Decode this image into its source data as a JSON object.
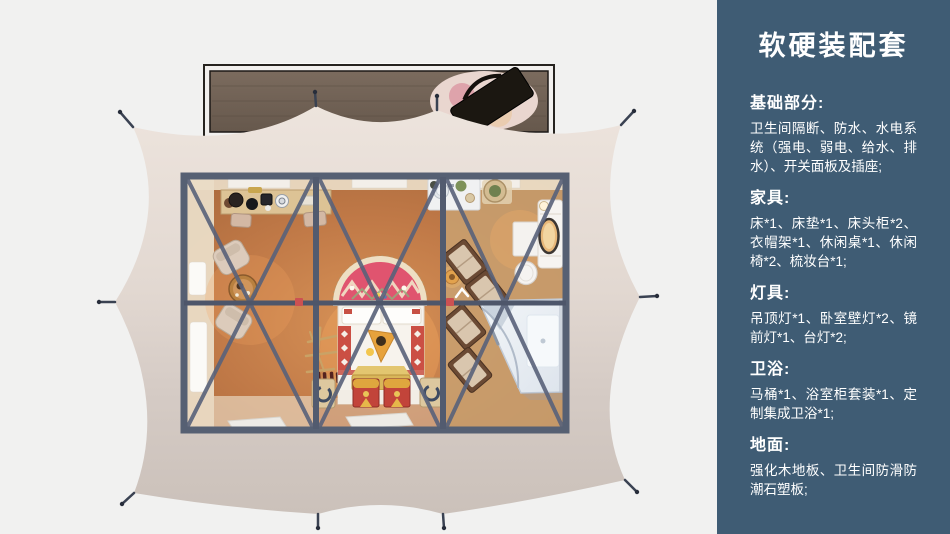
{
  "sidebar": {
    "title": "软硬装配套",
    "sections": [
      {
        "heading": "基础部分:",
        "body": "卫生间隔断、防水、水电系统（强电、弱电、给水、排水）、开关面板及插座;"
      },
      {
        "heading": "家具:",
        "body": "床*1、床垫*1、床头柜*2、衣帽架*1、休闲桌*1、休闲椅*2、梳妆台*1;"
      },
      {
        "heading": "灯具:",
        "body": "吊顶灯*1、卧室壁灯*2、镜前灯*1、台灯*2;"
      },
      {
        "heading": "卫浴:",
        "body": "马桶*1、浴室柜套装*1、定制集成卫浴*1;"
      },
      {
        "heading": "地面:",
        "body": "强化木地板、卫生间防滑防潮石塑板;"
      }
    ]
  },
  "colors": {
    "sidebar_bg": "#3f5c74",
    "canvas_bg": "#f1f1f0",
    "tent_fabric": "#e2d8d1",
    "frame_slate": "#566073",
    "floor_wood": "#bd7947",
    "deck_wood": "#75655a",
    "bed_accent_red": "#c75044",
    "headboard_rug_pink": "#e0546f",
    "chest_gold": "#dfa63e",
    "shower_white": "#eef1f5",
    "joint_red": "#cc5152"
  }
}
